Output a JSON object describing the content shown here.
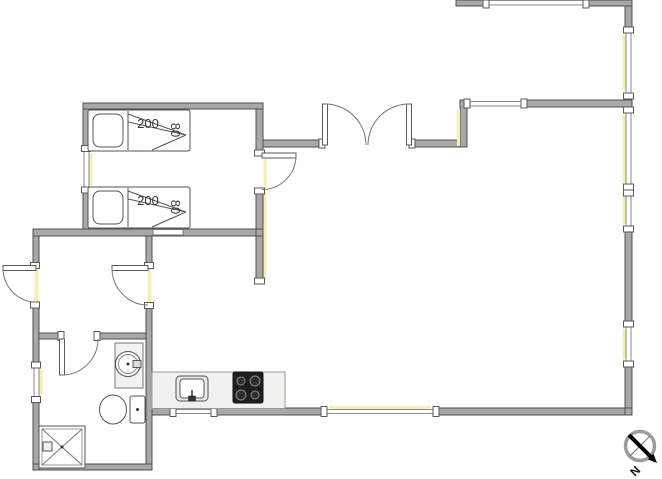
{
  "floor_plan": {
    "beds": [
      {
        "length_cm": "200",
        "width_cm": "80"
      },
      {
        "length_cm": "200",
        "width_cm": "80"
      }
    ],
    "compass": {
      "north_label": "N"
    },
    "fixtures": [
      "bed",
      "bed",
      "washbasin",
      "toilet",
      "shower",
      "kitchen-counter",
      "kitchen-sink",
      "stove"
    ],
    "colors": {
      "background": "#ffffff",
      "wall_fill": "#a8a8a8",
      "wall_outline": "#4f4f4f",
      "window_glass": "#f6efb5",
      "door_arc": "#777777",
      "stove": "#1e1e1e",
      "counter": "#f1f1ee",
      "compass_arrow": "#000000"
    }
  }
}
